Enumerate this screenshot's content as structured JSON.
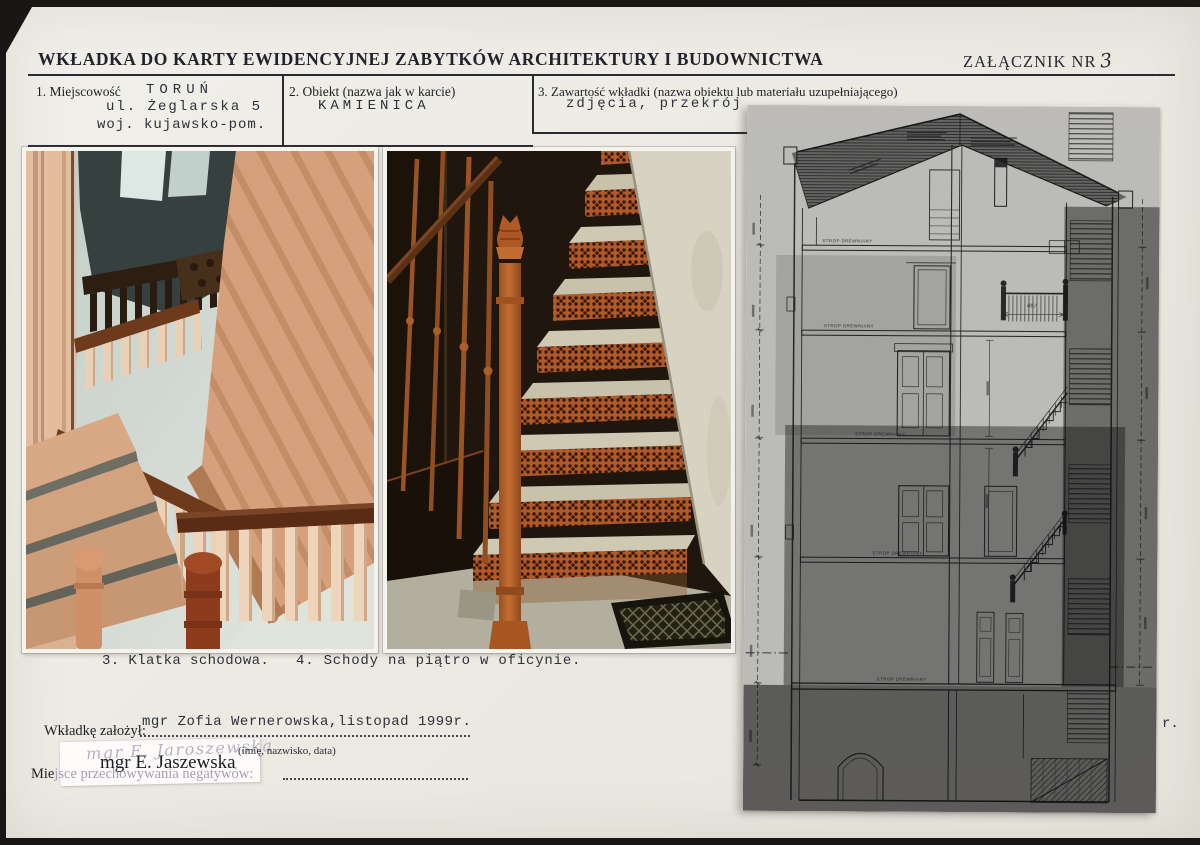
{
  "page": {
    "title": "WKŁADKA DO KARTY EWIDENCYJNEJ ZABYTKÓW ARCHITEKTURY I BUDOWNICTWA",
    "attachment": {
      "label": "ZAŁĄCZNIK NR",
      "number": "3"
    }
  },
  "fields": {
    "place": {
      "label": "1. Miejscowość",
      "line1": "TORUŃ",
      "line2": "ul. Żeglarska 5",
      "line3": "woj. kujawsko-pom."
    },
    "object": {
      "label": "2. Obiekt (nazwa jak w karcie)",
      "value": "KAMIENICA"
    },
    "contents": {
      "label": "3. Zawartość wkładki (nazwa obiektu lub materiału uzupełniającego)",
      "value": "zdjęcia, przekrój"
    }
  },
  "captions": {
    "photo3": "3. Klatka schodowa.",
    "photo4": "4. Schody na piątro w oficynie."
  },
  "footer": {
    "founder_label": "Wkładkę założył:",
    "founder_value": "mgr Zofia Wernerowska,listopad 1999r.",
    "founder_hint": "(imię, nazwisko, data)",
    "sticker_handwritten": "mgr E. Jaroszewska",
    "sticker_printed": "mgr E. Jaszewska",
    "negatives_prefix": "Mie",
    "negatives_rest": "jsce przechowywania negatywów:",
    "stray": "r."
  },
  "drawing": {
    "floor_label": "STROP DREWNIANY",
    "dim_landing": "467"
  },
  "colors": {
    "scanner_bg": "#181716",
    "card_paper": "#ece9e2",
    "sheet_paper": "#f8f7f2",
    "ink": "#2b2a32",
    "photo_salmon": "#d6a07c",
    "photo_rust": "#b15a28"
  }
}
